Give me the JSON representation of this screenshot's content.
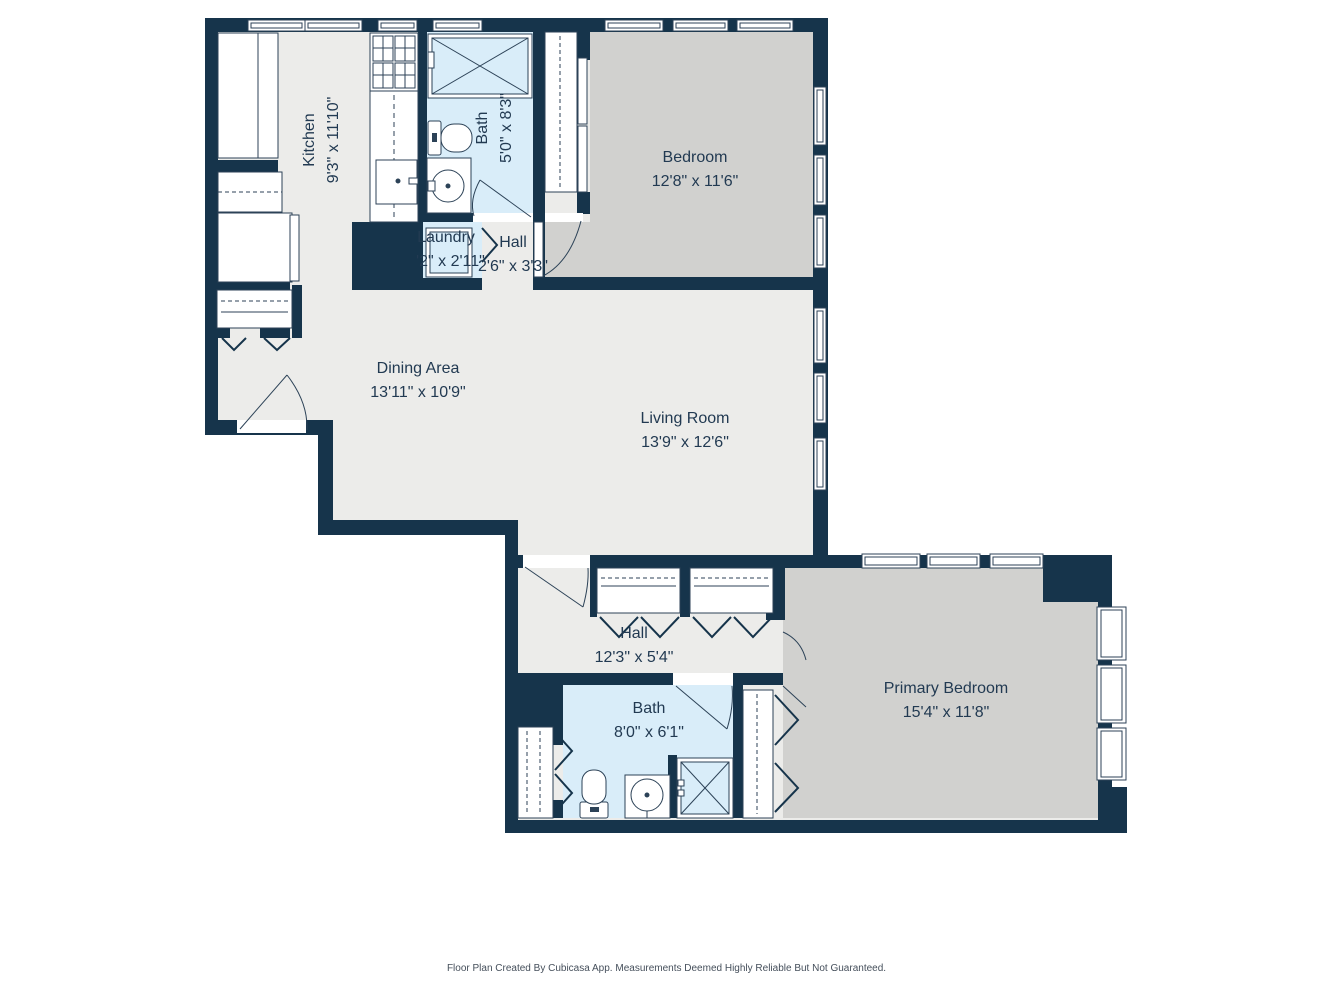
{
  "meta": {
    "footer": "Floor Plan Created By Cubicasa App. Measurements Deemed Highly Reliable But Not Guaranteed."
  },
  "colors": {
    "wall": "#16344b",
    "floor_light": "#ececea",
    "room_gray": "#d1d1cf",
    "wet_room_blue": "#d9edf9",
    "fixture_outline": "#2c4257",
    "label_text": "#223a52"
  },
  "rooms": [
    {
      "id": "kitchen",
      "name": "Kitchen",
      "dims": "9'3\" x 11'10\""
    },
    {
      "id": "bath-upper",
      "name": "Bath",
      "dims": "5'0\" x 8'3\""
    },
    {
      "id": "bedroom",
      "name": "Bedroom",
      "dims": "12'8\" x 11'6\""
    },
    {
      "id": "laundry",
      "name": "Laundry",
      "dims": "2'2\" x 2'11\""
    },
    {
      "id": "hall-upper",
      "name": "Hall",
      "dims": "2'6\" x 3'3\""
    },
    {
      "id": "dining-area",
      "name": "Dining Area",
      "dims": "13'11\" x 10'9\""
    },
    {
      "id": "living-room",
      "name": "Living Room",
      "dims": "13'9\" x 12'6\""
    },
    {
      "id": "hall-lower",
      "name": "Hall",
      "dims": "12'3\" x 5'4\""
    },
    {
      "id": "bath-lower",
      "name": "Bath",
      "dims": "8'0\" x 6'1\""
    },
    {
      "id": "primary-bedroom",
      "name": "Primary Bedroom",
      "dims": "15'4\" x 11'8\""
    }
  ]
}
